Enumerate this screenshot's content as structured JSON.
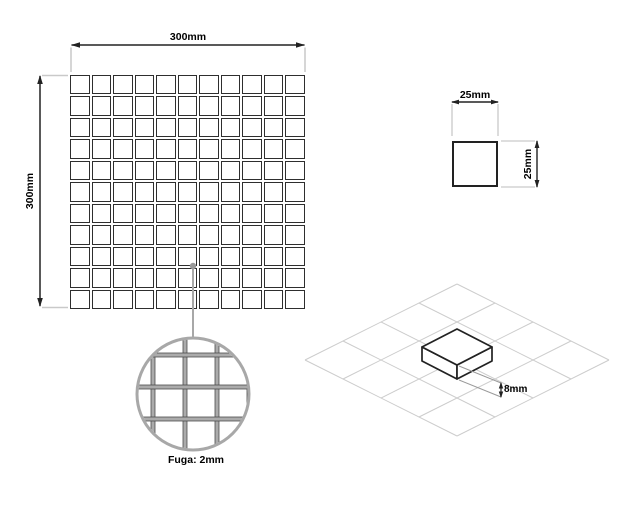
{
  "title": "Mosaic tile specification drawing",
  "mosaic": {
    "width_label": "300mm",
    "height_label": "300mm",
    "rows": 11,
    "cols": 11
  },
  "chip": {
    "width_label": "25mm",
    "height_label": "25mm"
  },
  "magnifier": {
    "grout_label": "Fuga: 2mm"
  },
  "isometric": {
    "thickness_label": "8mm"
  },
  "colors": {
    "line_dark": "#222222",
    "line_light": "#c9c9c9",
    "gray_medium": "#a8a8a8",
    "grout_fill": "#ababab",
    "iso_grid": "#cccccc",
    "text": "#000000"
  }
}
